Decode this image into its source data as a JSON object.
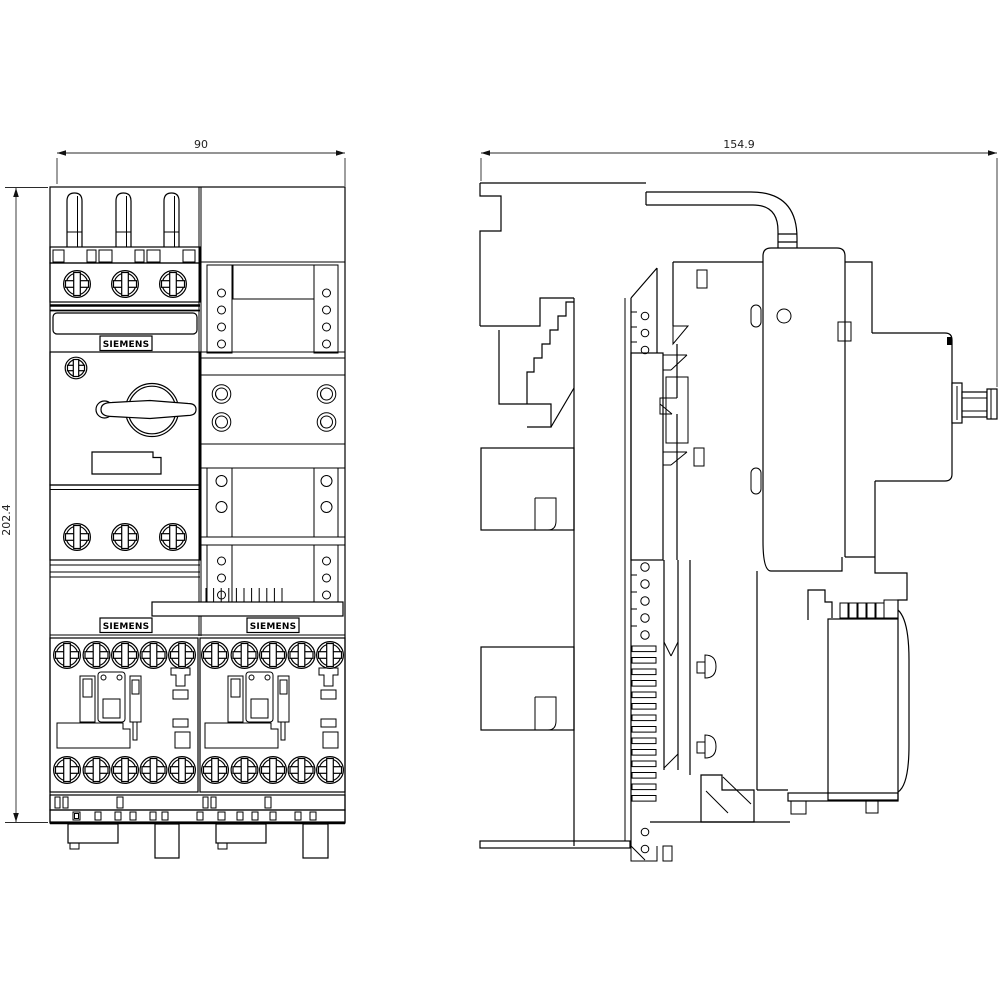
{
  "colors": {
    "background": "#ffffff",
    "line": "#000000"
  },
  "front_view": {
    "dimension_width": "90",
    "dimension_height": "202.4",
    "brand_label_breaker": "SIEMENS",
    "brand_label_contactor_left": "SIEMENS",
    "brand_label_contactor_right": "SIEMENS"
  },
  "side_view": {
    "dimension_depth": "154.9"
  }
}
